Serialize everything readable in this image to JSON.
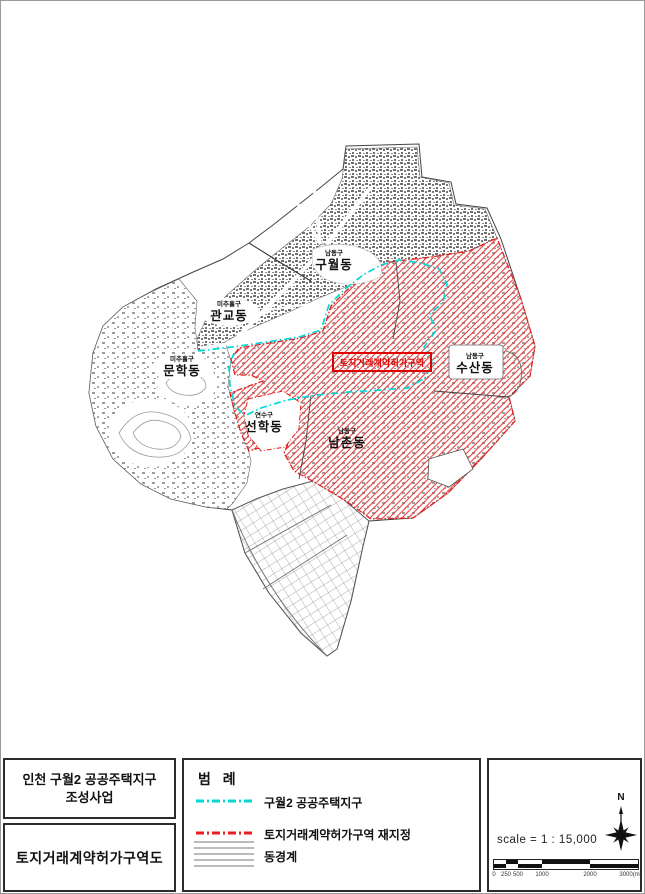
{
  "title_block": {
    "project_title_line1": "인천 구월2 공공주택지구",
    "project_title_line2": "조성사업",
    "map_title": "토지거래계약허가구역도"
  },
  "legend": {
    "title": "범 례",
    "items": [
      {
        "label": "구월2 공공주택지구",
        "style": "cyan-dashdot-line",
        "color": "#00d8d8"
      },
      {
        "label": "토지거래계약허가구역 재지정",
        "style": "red-dashdot-line",
        "color": "#ee1c1c"
      },
      {
        "label": "동경계",
        "style": "thin-gray-lines",
        "color": "#777777"
      }
    ]
  },
  "scale_panel": {
    "north_label": "N",
    "scale_text": "scale = 1 : 15,000",
    "scalebar_ticks": [
      "0",
      "250",
      "500",
      "1000",
      "2000",
      "3000(m)"
    ]
  },
  "map": {
    "zone_box_label": "토지거래계약허가구역",
    "districts": [
      {
        "gu": "남동구",
        "dong": "구월동"
      },
      {
        "gu": "미추홀구",
        "dong": "관교동"
      },
      {
        "gu": "미추홀구",
        "dong": "문학동"
      },
      {
        "gu": "남동구",
        "dong": "수산동"
      },
      {
        "gu": "연수구",
        "dong": "선학동"
      },
      {
        "gu": "남동구",
        "dong": "남촌동"
      }
    ]
  },
  "colors": {
    "district_boundary": "#444444",
    "housing_district_line": "#00d8d8",
    "permission_zone_line": "#e02020",
    "page_border": "#9a9a9a"
  }
}
